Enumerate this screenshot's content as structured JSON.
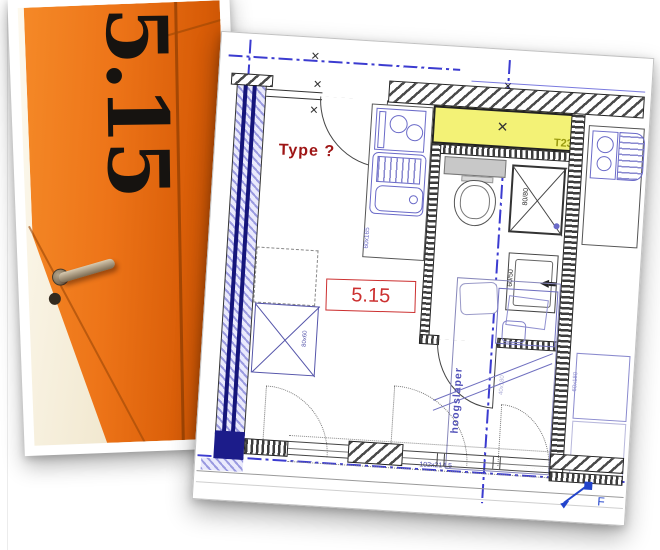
{
  "slide": {
    "background": "#ffffff"
  },
  "door_photo": {
    "stencil_number": "5.15",
    "door_color": "#ed7418"
  },
  "floor_plan": {
    "type_question": "Type ?",
    "room_number": "5.15",
    "unit_code": "T23",
    "marker_f": "F",
    "fixtures": {
      "shower_size": "80/80",
      "basin_size": "60/50",
      "wardrobe_size": "80x60",
      "kitchen_size": "60x165",
      "loftbed_name": "hoogslaper",
      "loftbed_size": "102x214,5",
      "table_size": "60x180",
      "bed_inner_size": "40x180"
    },
    "colors": {
      "highlight": "#f3f276",
      "wall_blue": "#9a9ae0",
      "annotation_red": "#9e1515",
      "label_red": "#cc3030",
      "centerline_blue": "#3b3bd0",
      "unit_code_color": "#99990f"
    }
  }
}
